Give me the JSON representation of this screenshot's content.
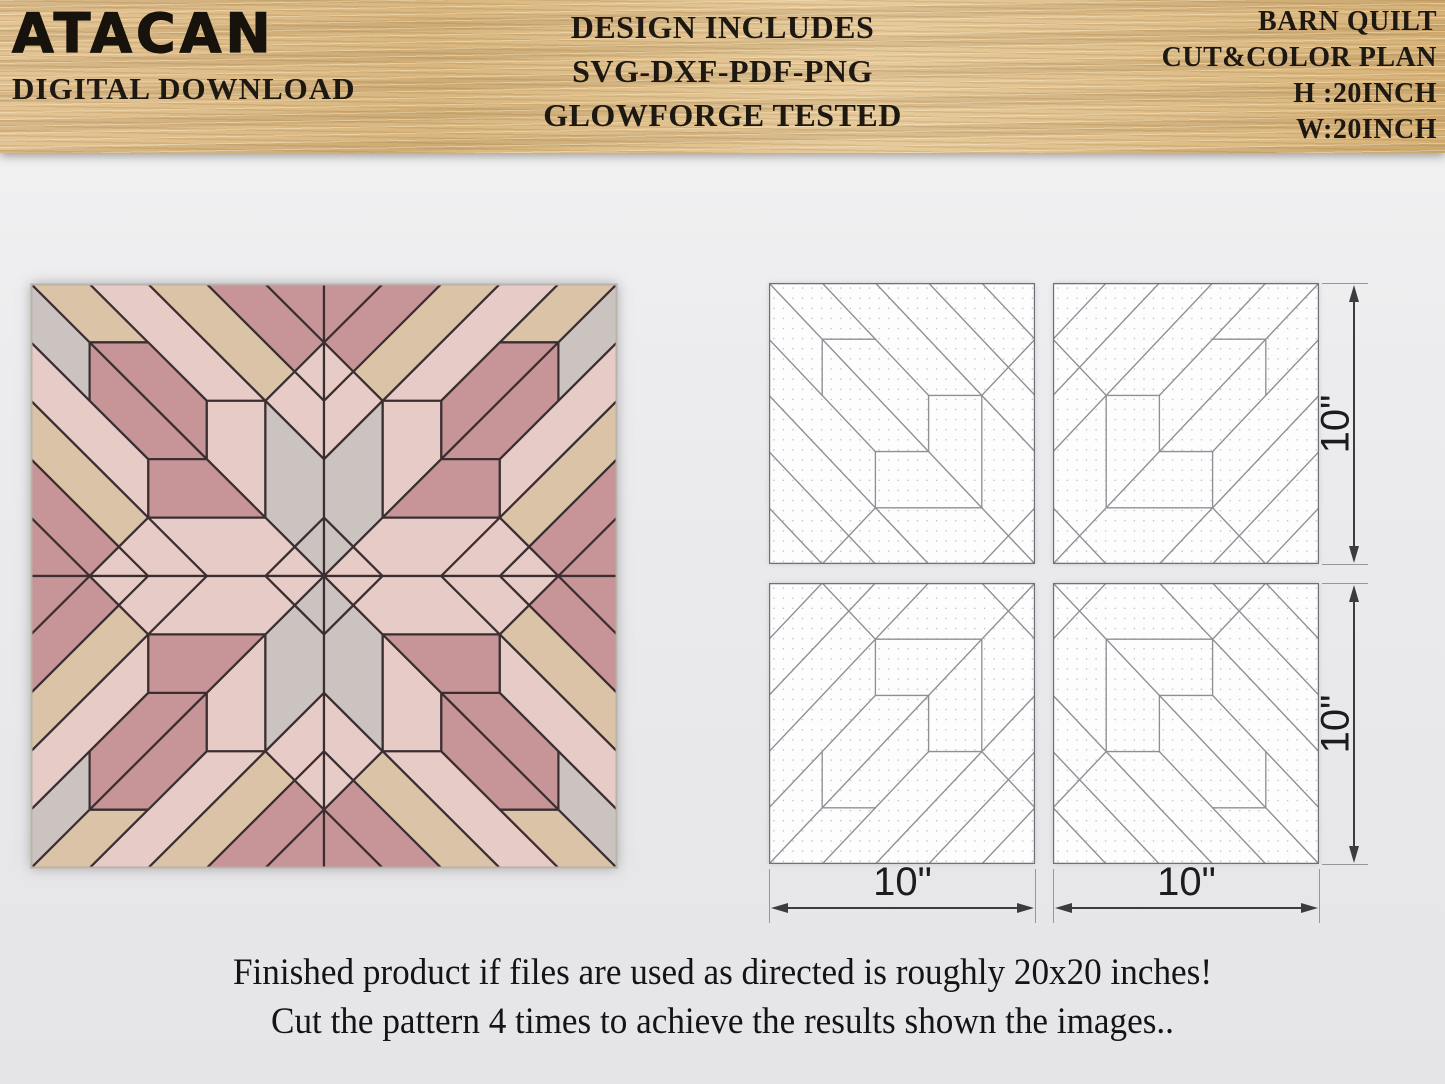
{
  "header": {
    "brand": "ATACAN",
    "tagline": "DIGITAL DOWNLOAD",
    "center_lines": [
      "DESIGN INCLUDES",
      "SVG-DXF-PDF-PNG",
      "GLOWFORGE TESTED"
    ],
    "right_lines": [
      "BARN QUILT",
      "CUT&COLOR PLAN",
      "H :20INCH",
      "W:20INCH"
    ]
  },
  "caption": {
    "line1": "Finished product if files are used as directed is roughly 20x20 inches!",
    "line2": "Cut the pattern 4 times to achieve the results shown the images.."
  },
  "dimensions": {
    "bottom_left": "10\"",
    "bottom_right": "10\"",
    "right_top": "10\"",
    "right_bottom": "10\""
  },
  "quilt": {
    "size_units": 20,
    "tile_units": 10,
    "stroke": "#3a2e31",
    "colors": {
      "beige": "#dbc3a8",
      "gray": "#cac3c0",
      "pink": "#e7cbc6",
      "mauve": "#c79598"
    },
    "pieces": [
      {
        "color": "beige",
        "points": [
          [
            0,
            0
          ],
          [
            2,
            0
          ],
          [
            4,
            2
          ],
          [
            2,
            2
          ]
        ]
      },
      {
        "color": "gray",
        "points": [
          [
            0,
            0
          ],
          [
            0,
            2
          ],
          [
            2,
            4
          ],
          [
            2,
            2
          ]
        ]
      },
      {
        "color": "pink",
        "points": [
          [
            2,
            0
          ],
          [
            4,
            0
          ],
          [
            8,
            4
          ],
          [
            6,
            4
          ]
        ]
      },
      {
        "color": "beige",
        "points": [
          [
            4,
            0
          ],
          [
            6,
            0
          ],
          [
            9,
            3
          ],
          [
            8,
            4
          ]
        ]
      },
      {
        "color": "mauve",
        "points": [
          [
            6,
            0
          ],
          [
            8,
            0
          ],
          [
            10,
            2
          ],
          [
            9,
            3
          ]
        ]
      },
      {
        "color": "mauve",
        "points": [
          [
            8,
            0
          ],
          [
            10,
            0
          ],
          [
            10,
            2
          ]
        ]
      },
      {
        "color": "pink",
        "points": [
          [
            10,
            2
          ],
          [
            10,
            4
          ],
          [
            9,
            3
          ]
        ]
      },
      {
        "color": "pink",
        "points": [
          [
            9,
            3
          ],
          [
            10,
            4
          ],
          [
            10,
            6
          ],
          [
            8,
            4
          ]
        ]
      },
      {
        "color": "mauve",
        "points": [
          [
            2,
            2
          ],
          [
            4,
            2
          ],
          [
            6,
            4
          ],
          [
            6,
            6
          ]
        ]
      },
      {
        "color": "mauve",
        "points": [
          [
            2,
            2
          ],
          [
            2,
            4
          ],
          [
            4,
            6
          ],
          [
            6,
            6
          ]
        ]
      },
      {
        "color": "pink",
        "points": [
          [
            6,
            4
          ],
          [
            8,
            4
          ],
          [
            8,
            8
          ],
          [
            6,
            6
          ]
        ]
      },
      {
        "color": "mauve",
        "points": [
          [
            4,
            6
          ],
          [
            6,
            6
          ],
          [
            8,
            8
          ],
          [
            4,
            8
          ]
        ]
      },
      {
        "color": "gray",
        "points": [
          [
            8,
            4
          ],
          [
            10,
            6
          ],
          [
            10,
            8
          ],
          [
            9,
            9
          ],
          [
            8,
            8
          ]
        ]
      },
      {
        "color": "gray",
        "points": [
          [
            9,
            9
          ],
          [
            10,
            8
          ],
          [
            10,
            10
          ]
        ]
      },
      {
        "color": "pink",
        "points": [
          [
            8,
            10
          ],
          [
            9,
            9
          ],
          [
            10,
            10
          ]
        ]
      },
      {
        "color": "pink",
        "points": [
          [
            4,
            8
          ],
          [
            8,
            8
          ],
          [
            9,
            9
          ],
          [
            8,
            10
          ],
          [
            6,
            10
          ]
        ]
      },
      {
        "color": "pink",
        "points": [
          [
            0,
            2
          ],
          [
            0,
            4
          ],
          [
            4,
            8
          ],
          [
            4,
            6
          ]
        ]
      },
      {
        "color": "beige",
        "points": [
          [
            0,
            4
          ],
          [
            0,
            6
          ],
          [
            3,
            9
          ],
          [
            4,
            8
          ]
        ]
      },
      {
        "color": "mauve",
        "points": [
          [
            0,
            6
          ],
          [
            0,
            8
          ],
          [
            2,
            10
          ],
          [
            3,
            9
          ]
        ]
      },
      {
        "color": "mauve",
        "points": [
          [
            0,
            8
          ],
          [
            0,
            10
          ],
          [
            2,
            10
          ]
        ]
      },
      {
        "color": "pink",
        "points": [
          [
            2,
            10
          ],
          [
            4,
            10
          ],
          [
            3,
            9
          ]
        ]
      },
      {
        "color": "pink",
        "points": [
          [
            3,
            9
          ],
          [
            4,
            10
          ],
          [
            6,
            10
          ],
          [
            4,
            8
          ]
        ]
      }
    ]
  },
  "line_tile": {
    "line_color": "#8e8e94",
    "border_color": "#6f6f76",
    "dot_color": "#b8b8c0",
    "segments": [
      [
        0,
        0,
        10,
        10
      ],
      [
        2,
        0,
        6,
        4
      ],
      [
        4,
        0,
        10,
        6
      ],
      [
        6,
        0,
        10,
        4
      ],
      [
        8,
        0,
        10,
        2
      ],
      [
        0,
        2,
        4,
        6
      ],
      [
        0,
        4,
        6,
        10
      ],
      [
        0,
        6,
        4,
        10
      ],
      [
        0,
        8,
        2,
        10
      ],
      [
        10,
        2,
        8,
        4
      ],
      [
        2,
        10,
        4,
        8
      ],
      [
        8,
        10,
        10,
        8
      ],
      [
        2,
        2,
        4,
        2
      ],
      [
        6,
        4,
        8,
        4
      ],
      [
        4,
        6,
        6,
        6
      ],
      [
        4,
        8,
        8,
        8
      ],
      [
        2,
        2,
        2,
        4
      ],
      [
        6,
        4,
        6,
        6
      ],
      [
        8,
        4,
        8,
        8
      ],
      [
        4,
        6,
        4,
        8
      ]
    ]
  }
}
